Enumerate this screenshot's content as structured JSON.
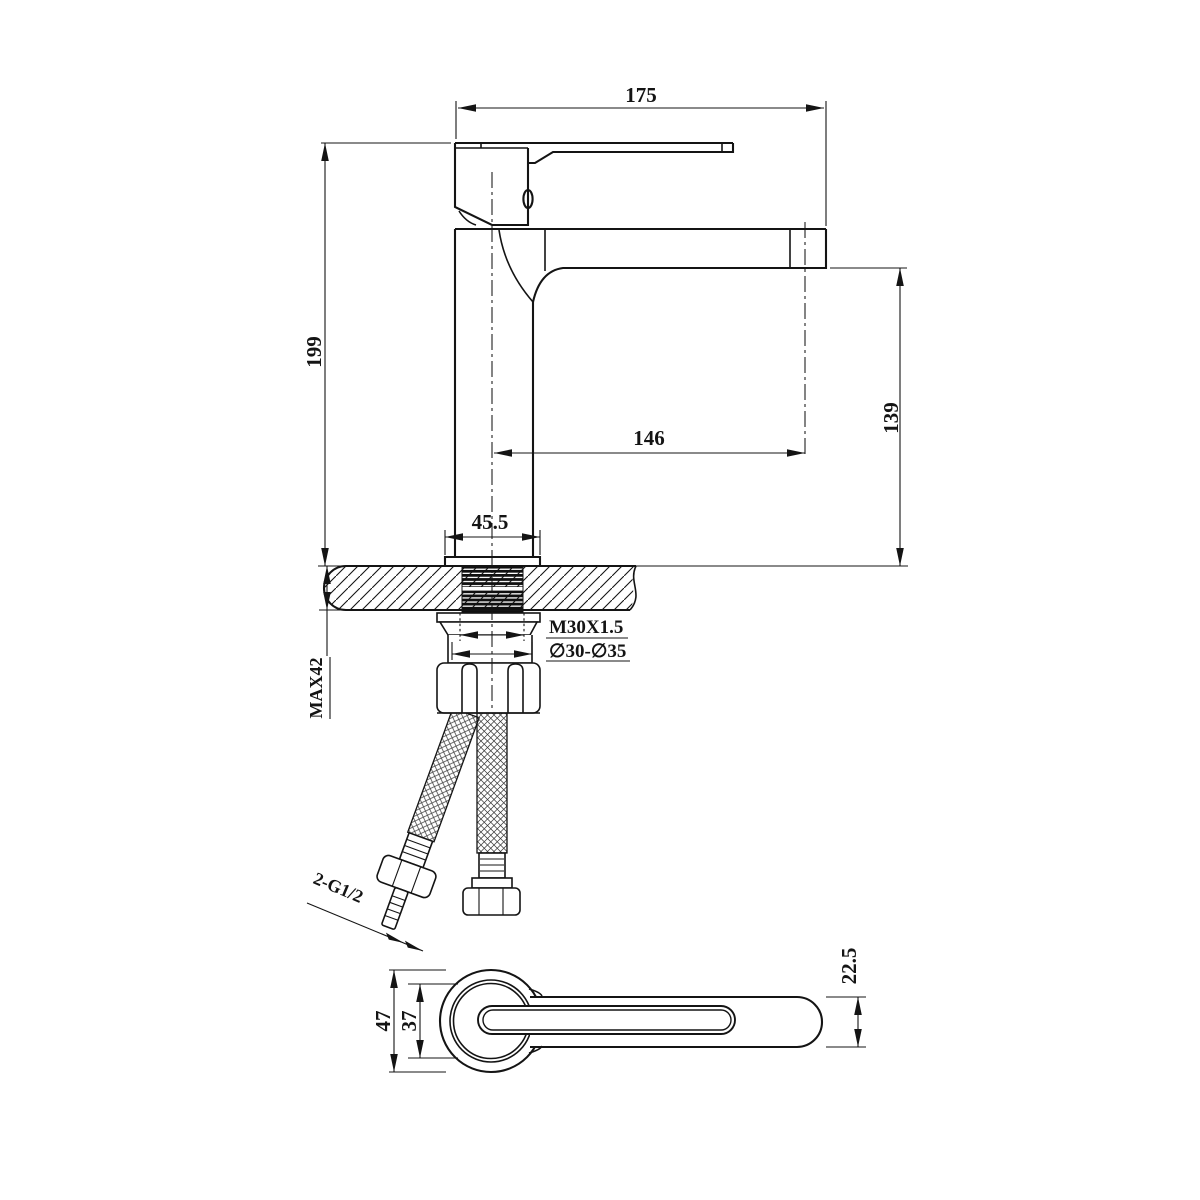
{
  "colors": {
    "line": "#141414",
    "background": "#ffffff"
  },
  "front_view": {
    "dim_total_width": "175",
    "dim_total_height": "199",
    "dim_spout_reach": "146",
    "dim_spout_height": "139",
    "dim_base_width": "45.5",
    "label_thread": "M30X1.5",
    "label_hole_range": "∅30-∅35",
    "label_counter_thickness": "MAX42",
    "label_hose_thread": "2-G1/2"
  },
  "plan_view": {
    "dim_body_outer": "47",
    "dim_body_inner": "37",
    "dim_lever_width": "22.5"
  }
}
